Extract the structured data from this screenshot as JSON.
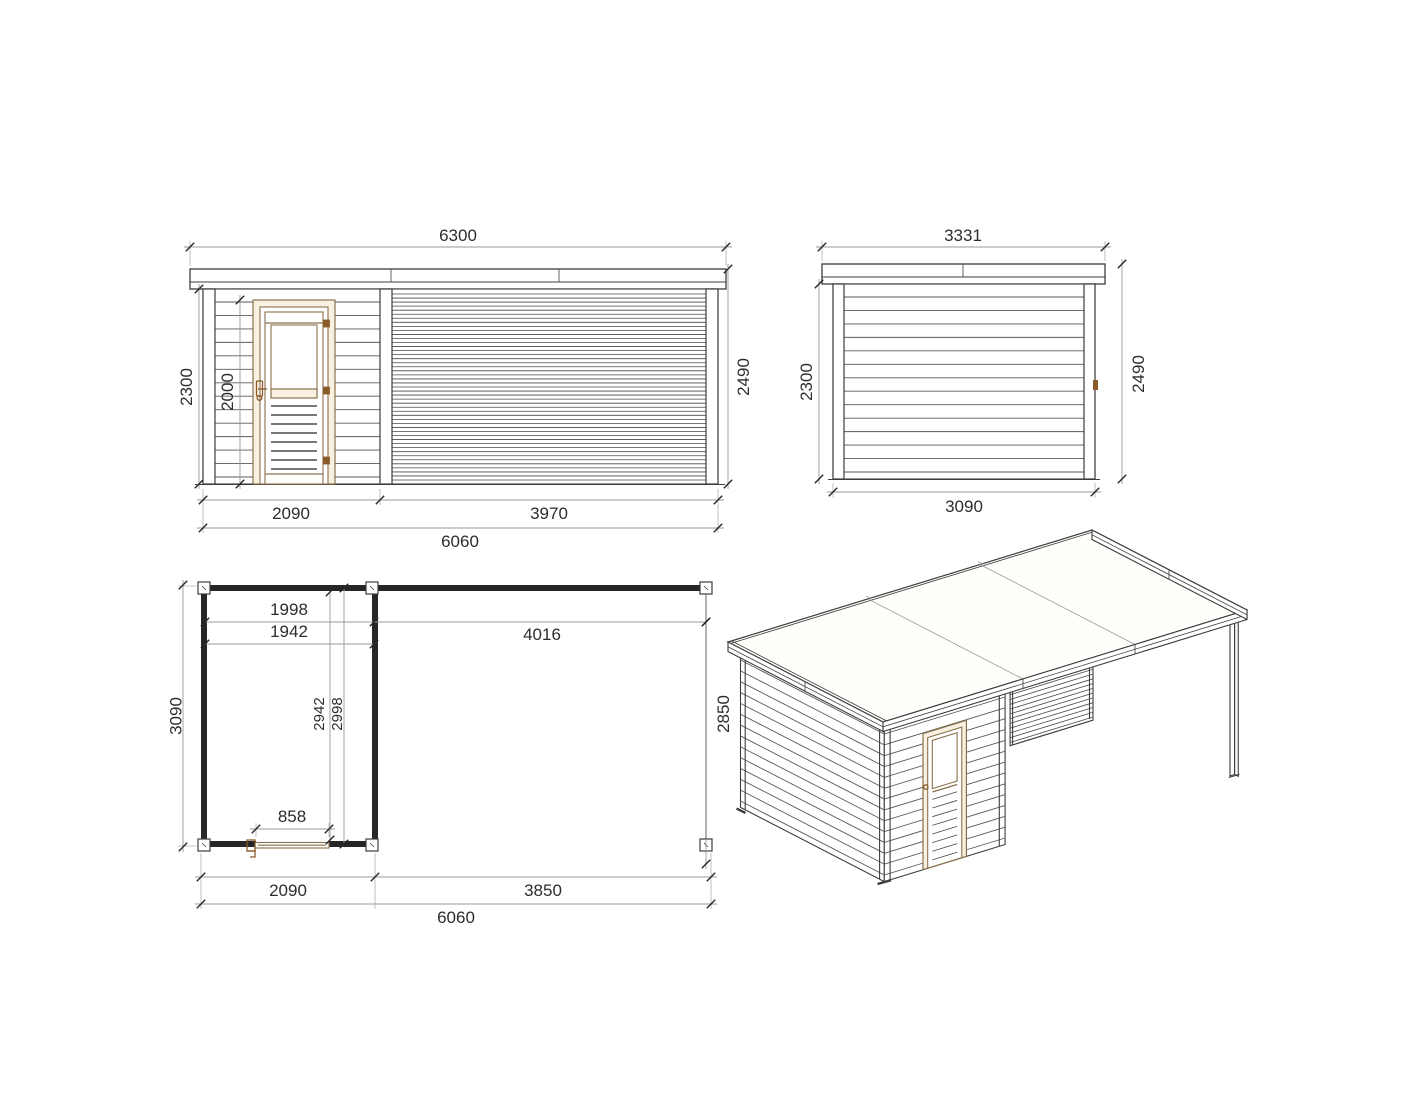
{
  "front": {
    "roof_width": "6300",
    "wall_height": "2300",
    "door_height": "2000",
    "total_height": "2490",
    "seg_left": "2090",
    "seg_right": "3970",
    "total_width": "6060"
  },
  "side": {
    "roof_width": "3331",
    "wall_height": "2300",
    "total_height": "2490",
    "width": "3090"
  },
  "plan": {
    "inner_width": "1998",
    "frame_width": "1942",
    "pergola_width": "4016",
    "depth": "3090",
    "inner_depth": "2942",
    "inner_depth_full": "2998",
    "pergola_depth": "2850",
    "door_width": "858",
    "seg_left": "2090",
    "seg_right": "3850",
    "total_width": "6060"
  },
  "colors": {
    "line": "#3d3d3d",
    "siding": "#5a5a5a",
    "slat": "#4a4a4a",
    "dim": "#9a9a9a",
    "ext": "#b0b0b0",
    "ink": "#262626",
    "text": "#2d2d2d",
    "wood": "#8a714d",
    "wood_dark": "#8a5a28",
    "wood_fill": "#f8f0e0"
  }
}
